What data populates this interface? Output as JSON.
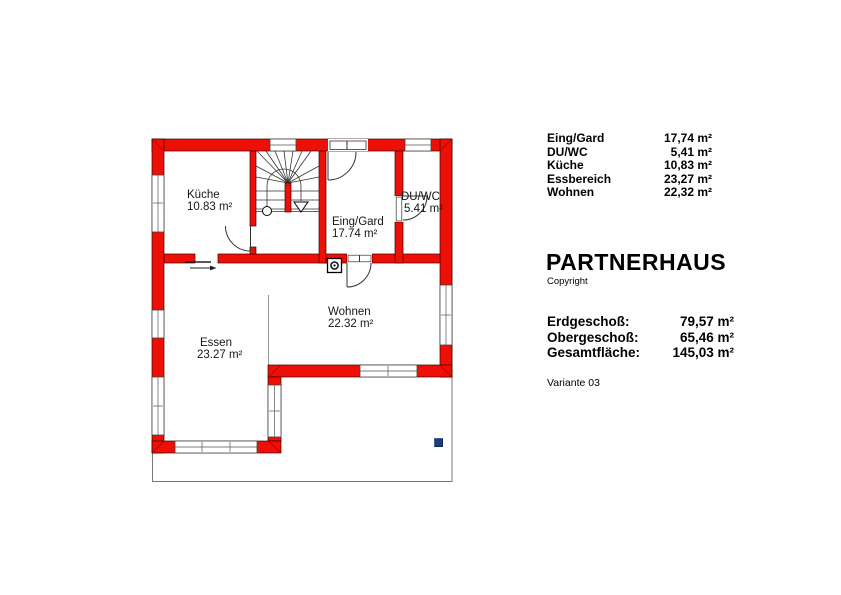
{
  "plan": {
    "colors": {
      "wall": "#ee1006",
      "site_border": "#777777",
      "room_divider": "#999999",
      "logo_blue": "#1c3d7c"
    },
    "rooms": {
      "kueche": {
        "name": "Küche",
        "area": "10.83 m²"
      },
      "eing": {
        "name": "Eing/Gard",
        "area": "17.74 m²"
      },
      "duwc": {
        "name": "DU/WC",
        "area": "5.41 m²"
      },
      "wohnen": {
        "name": "Wohnen",
        "area": "22.32 m²"
      },
      "essen": {
        "name": "Essen",
        "area": "23.27 m²"
      }
    }
  },
  "panel": {
    "rooms": [
      {
        "label": "Eing/Gard",
        "value": "17,74 m²"
      },
      {
        "label": "DU/WC",
        "value": "5,41 m²"
      },
      {
        "label": "Küche",
        "value": "10,83 m²"
      },
      {
        "label": "Essbereich",
        "value": "23,27 m²"
      },
      {
        "label": "Wohnen",
        "value": "22,32 m²"
      }
    ],
    "title": "PARTNERHAUS",
    "copyright": "Copyright",
    "totals": [
      {
        "label": "Erdgeschoß:",
        "value": "79,57 m²"
      },
      {
        "label": "Obergeschoß:",
        "value": "65,46 m²"
      },
      {
        "label": "Gesamtfläche:",
        "value": "145,03 m²"
      }
    ],
    "variant": "Variante 03"
  }
}
